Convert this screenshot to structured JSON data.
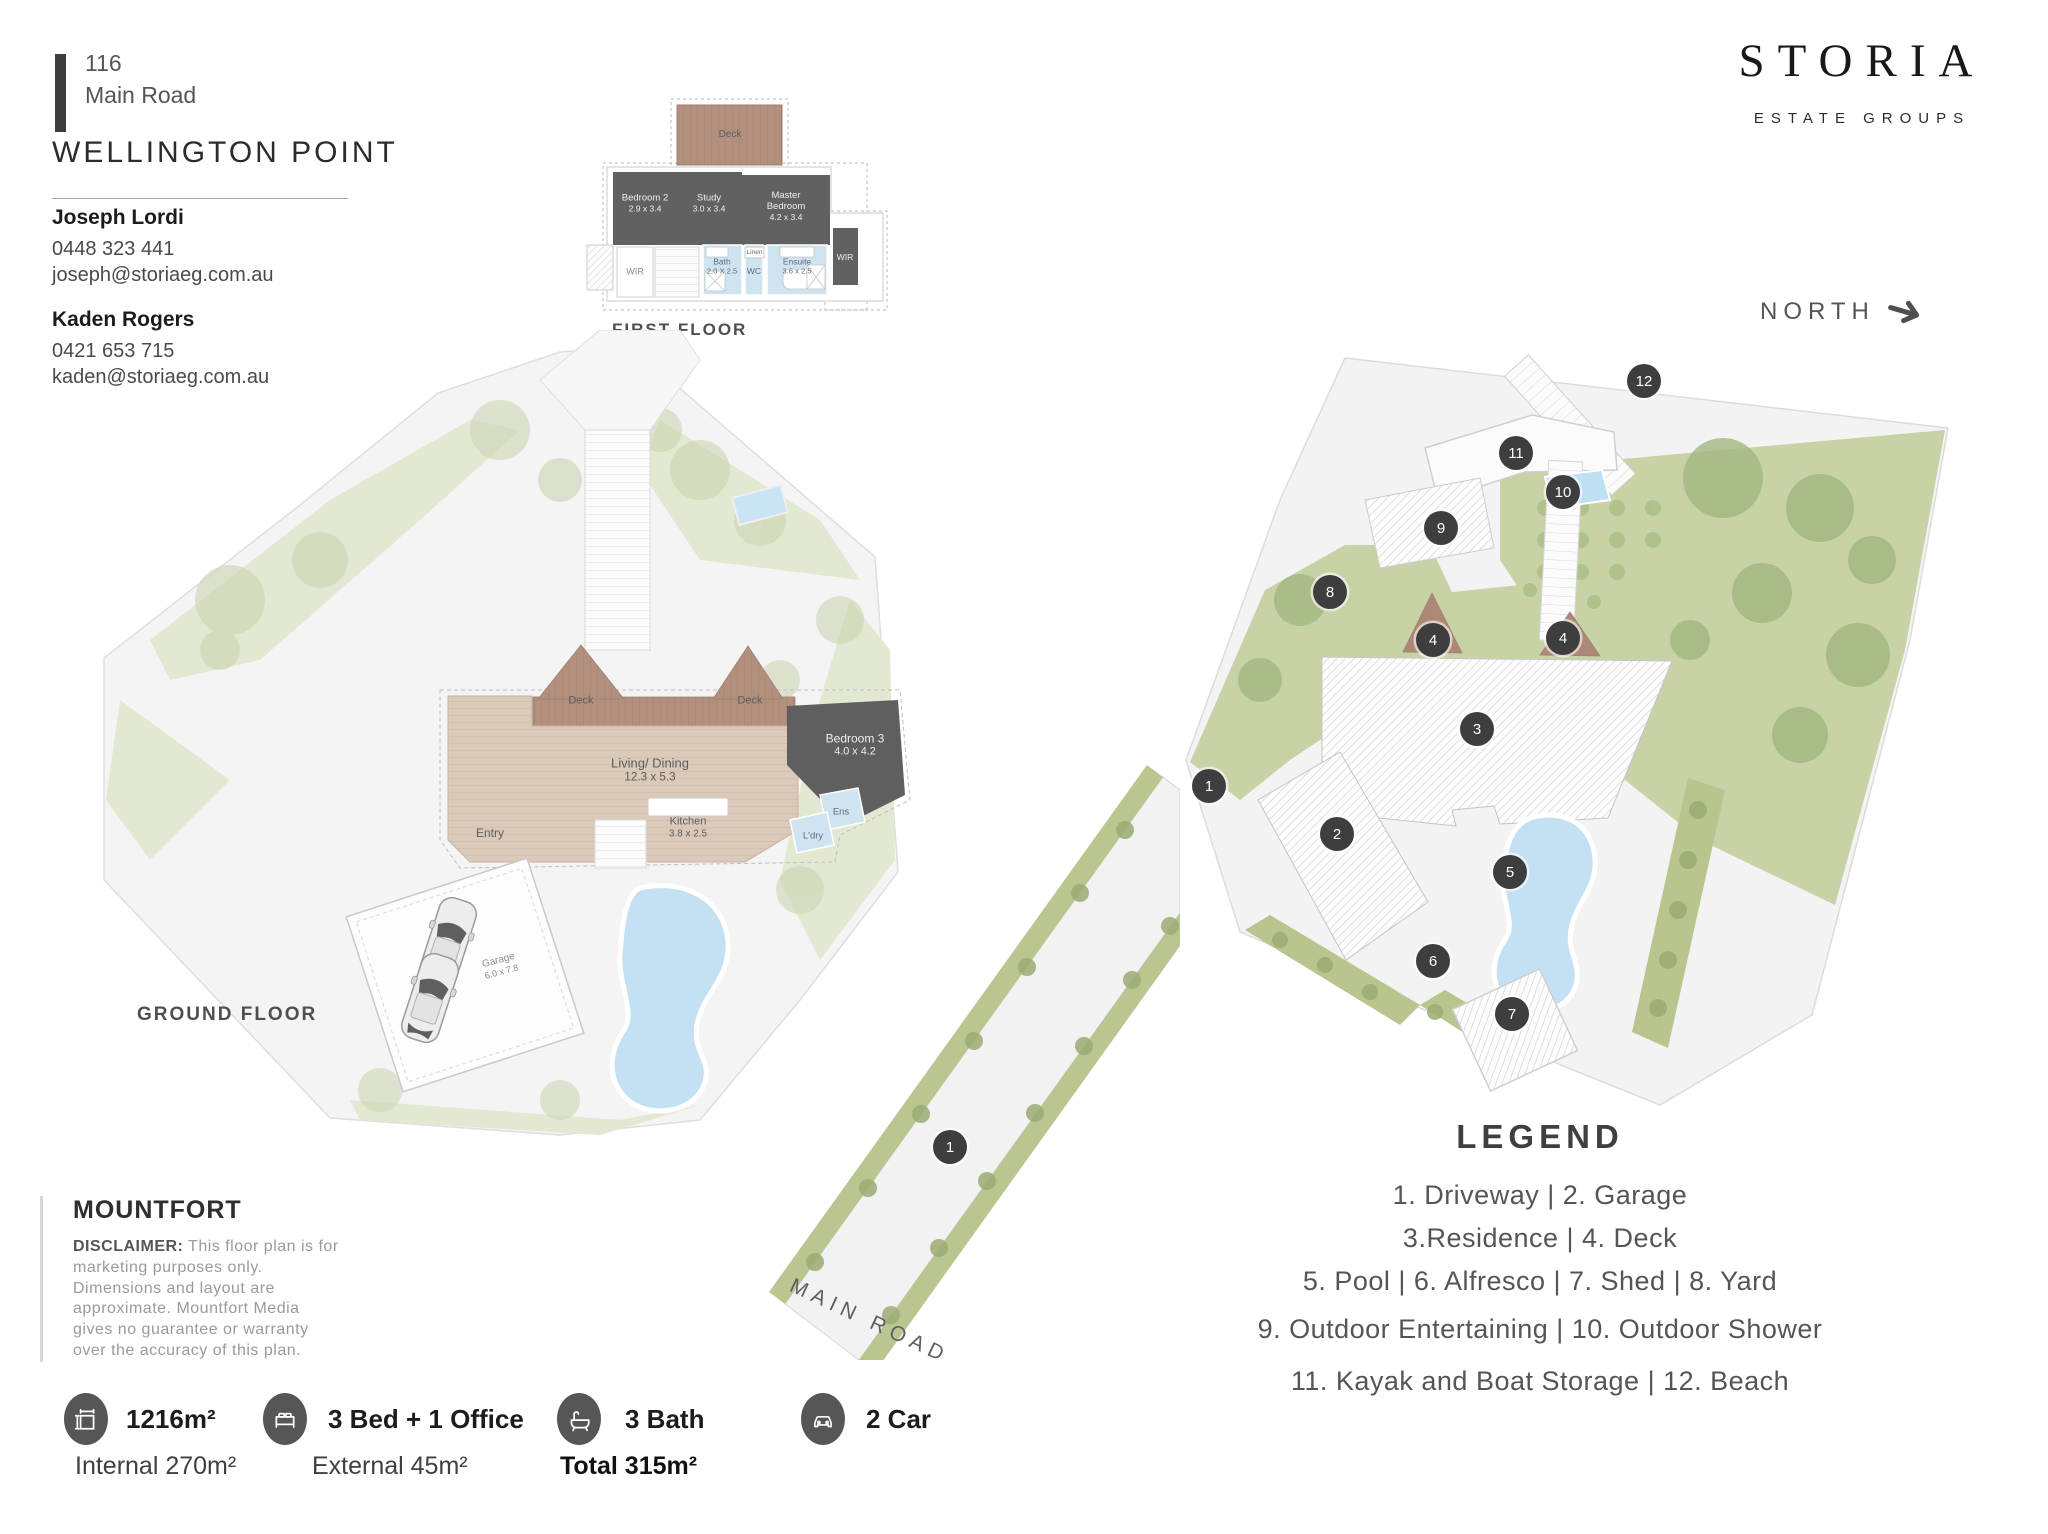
{
  "brand": {
    "logo": "STORIA",
    "tagline": "ESTATE GROUPS"
  },
  "header": {
    "street_number": "116",
    "street_name": "Main Road",
    "suburb": "WELLINGTON POINT"
  },
  "agents": [
    {
      "name": "Joseph Lordi",
      "phone": "0448 323 441",
      "email": "joseph@storiaeg.com.au"
    },
    {
      "name": "Kaden Rogers",
      "phone": "0421 653 715",
      "email": "kaden@storiaeg.com.au"
    }
  ],
  "compass": {
    "label": "NORTH"
  },
  "first_floor": {
    "title": "FIRST FLOOR",
    "deck": "Deck",
    "bedroom2_name": "Bedroom 2",
    "bedroom2_dim": "2.9 x 3.4",
    "study_name": "Study",
    "study_dim": "3.0 x 3.4",
    "master_name": "Master Bedroom",
    "master_dim": "4.2 x 3.4",
    "wir_left": "WIR",
    "wir_right": "WIR",
    "bath_name": "Bath",
    "bath_dim": "2.0 X 2.5",
    "wc": "WC",
    "linen": "Linen",
    "ensuite_name": "Ensuite",
    "ensuite_dim": "3.6 x 2.5"
  },
  "ground_floor": {
    "title": "GROUND FLOOR",
    "deck_left": "Deck",
    "deck_right": "Deck",
    "living_name": "Living/ Dining",
    "living_dim": "12.3 x 5.3",
    "entry": "Entry",
    "kitchen_name": "Kitchen",
    "kitchen_dim": "3.8 x 2.5",
    "bedroom3_name": "Bedroom 3",
    "bedroom3_dim": "4.0 x 4.2",
    "ens": "Ens",
    "ldry": "L'dry",
    "garage_name": "Garage",
    "garage_dim": "6.0 x 7.8"
  },
  "site_plan": {
    "road_label": "MAIN ROAD",
    "markers": [
      "1",
      "2",
      "3",
      "4",
      "4",
      "5",
      "6",
      "7",
      "8",
      "9",
      "10",
      "11",
      "12",
      "1"
    ]
  },
  "legend": {
    "title": "LEGEND",
    "lines": [
      "1. Driveway  |  2. Garage",
      "3.Residence |  4. Deck",
      "5. Pool | 6. Alfresco  |  7. Shed  |  8. Yard",
      "9. Outdoor Entertaining | 10. Outdoor Shower",
      "11. Kayak and Boat Storage  |  12. Beach"
    ]
  },
  "disclaimer": {
    "brand": "MOUNTFORT",
    "label": "DISCLAIMER:",
    "text": "This floor plan is for marketing purposes only. Dimensions and layout are approximate. Mountfort Media gives no guarantee or warranty over the accuracy of this plan."
  },
  "stats": {
    "items": [
      {
        "icon": "area-icon",
        "label": "1216m²"
      },
      {
        "icon": "bed-icon",
        "label": "3 Bed + 1 Office"
      },
      {
        "icon": "bath-icon",
        "label": "3 Bath"
      },
      {
        "icon": "car-icon",
        "label": "2 Car"
      }
    ],
    "internal": "Internal 270m²",
    "external": "External 45m²",
    "total": "Total 315m²"
  },
  "colors": {
    "marker": "#3e3e3e",
    "room_dark": "#616161",
    "deck_wood": "#b3907e",
    "floor_wood": "#dbc9ba",
    "wet_blue": "#cfe3f0",
    "pool_blue": "#c3e1f3",
    "grass": "#c7d3a6",
    "site_gray": "#f3f3f3"
  }
}
